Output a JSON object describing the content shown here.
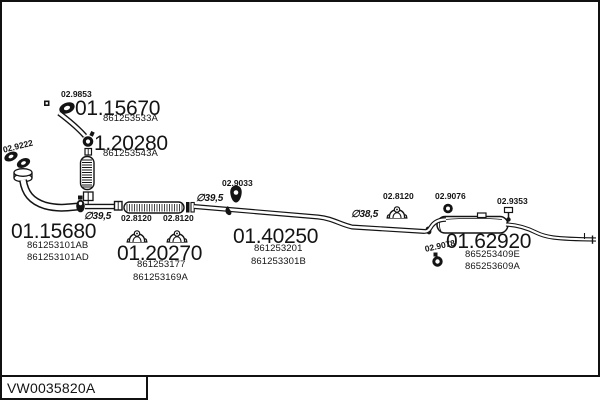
{
  "footer": {
    "catalog_code": "VW0035820A"
  },
  "diagram": {
    "parts": [
      {
        "number": "01.15670",
        "refs": [
          "861253533A"
        ]
      },
      {
        "number": "1.20280",
        "refs": [
          "861253543A"
        ]
      },
      {
        "number": "01.15680",
        "refs": [
          "861253101AB",
          "861253101AD"
        ]
      },
      {
        "number": "01.20270",
        "refs": [
          "861253177",
          "861253169A"
        ]
      },
      {
        "number": "01.40250",
        "refs": [
          "861253201",
          "861253301B"
        ]
      },
      {
        "number": "01.62920",
        "refs": [
          "865253409E",
          "865253609A"
        ]
      }
    ],
    "fitting_codes": {
      "gasket_top": "02.9853",
      "flange_gasket": "02.9222",
      "clamp_left_1": "02.8120",
      "clamp_left_2": "02.8120",
      "hanger_mid": "02.9033",
      "clamp_right": "02.8120",
      "hanger_muffler_front": "02.9076",
      "hanger_muffler_bottom": "02.9078",
      "hanger_tail": "02.9353"
    },
    "diameters": {
      "downpipe": "∅39,5",
      "mid_pipe": "∅39,5",
      "rear_pipe": "∅38,5"
    }
  }
}
